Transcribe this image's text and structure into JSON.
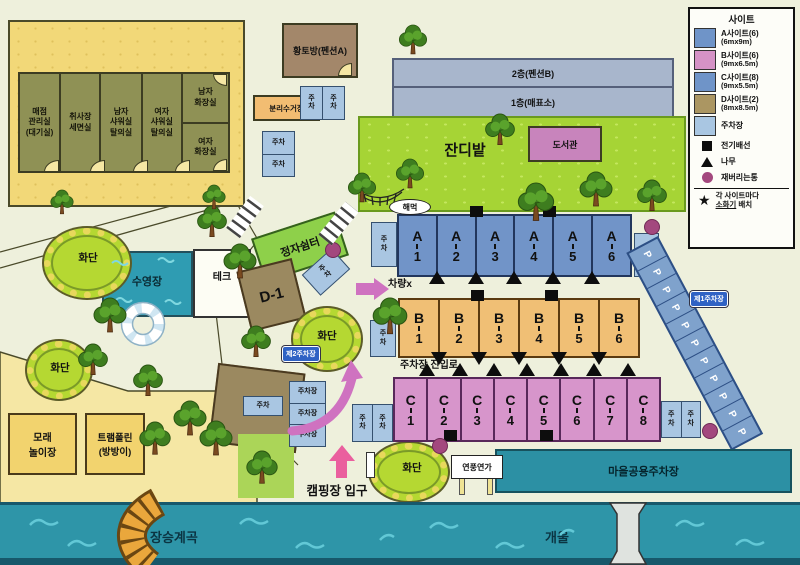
{
  "legend": {
    "title": "사이트",
    "sites": [
      {
        "name": "A사이트(6)",
        "size": "(6mx9m)",
        "color": "#6f94c8"
      },
      {
        "name": "B사이트(6)",
        "size": "(9mx6.5m)",
        "color": "#d592c6"
      },
      {
        "name": "C사이트(8)",
        "size": "(9mx5.5m)",
        "color": "#6f94c8"
      },
      {
        "name": "D사이트(2)",
        "size": "(8mx8.5m)",
        "color": "#ab9662"
      },
      {
        "name": "주차장",
        "size": "",
        "color": "#a9c6e2"
      }
    ],
    "symbols": [
      {
        "icon": "square",
        "label": "전기배선"
      },
      {
        "icon": "triangle",
        "label": "나무"
      },
      {
        "icon": "circle",
        "label": "재버리는통"
      }
    ],
    "note": {
      "icon": "star",
      "line1": "각 사이트마다",
      "underline": "소화기",
      "rest": " 배치"
    }
  },
  "buildings": {
    "rooms": [
      "매점\n관리실\n(대기실)",
      "취사장\n세면실",
      "남자\n샤워실\n탈의실",
      "여자\n샤워실\n탈의실",
      "남자\n화장실",
      "여자\n화장실"
    ],
    "hwangto": "황토방(펜션A)",
    "pension2f": "2층(펜션B)",
    "floor1": "1층(매표소)",
    "recycle": "분리수거장",
    "library": "도서관"
  },
  "areas": {
    "lawn": "잔디밭",
    "pool": "수영장",
    "deck": "테크",
    "pavilion": "정자쉼터",
    "flowerbed": "화단",
    "sand": "모래\n놀이장",
    "trampoline": "트램폴린\n(방방이)",
    "village_parking": "마을공용주차장",
    "valley": "장승계곡",
    "stream": "개울"
  },
  "sites": {
    "a": {
      "letter": "A",
      "numbers": [
        "1",
        "2",
        "3",
        "4",
        "5",
        "6"
      ]
    },
    "b": {
      "letter": "B",
      "numbers": [
        "1",
        "2",
        "3",
        "4",
        "5",
        "6"
      ]
    },
    "c": {
      "letter": "C",
      "numbers": [
        "1",
        "2",
        "3",
        "4",
        "5",
        "6",
        "7",
        "8"
      ]
    },
    "d1": "D-1",
    "d2": "D-2"
  },
  "parking": {
    "cell_h": "주차",
    "cell_v": "주\n차",
    "lot": "주차장",
    "p": "P",
    "p_count": 11,
    "stack_count": 3,
    "tag_left": "제2주차장",
    "tag_right": "제1주차장"
  },
  "annotations": {
    "no_car": "차량x",
    "entry_road": "주차장 진입로",
    "camp_entrance": "캠핑장 입구",
    "hammock": "해먹",
    "pension_sign": "연풍연가"
  }
}
